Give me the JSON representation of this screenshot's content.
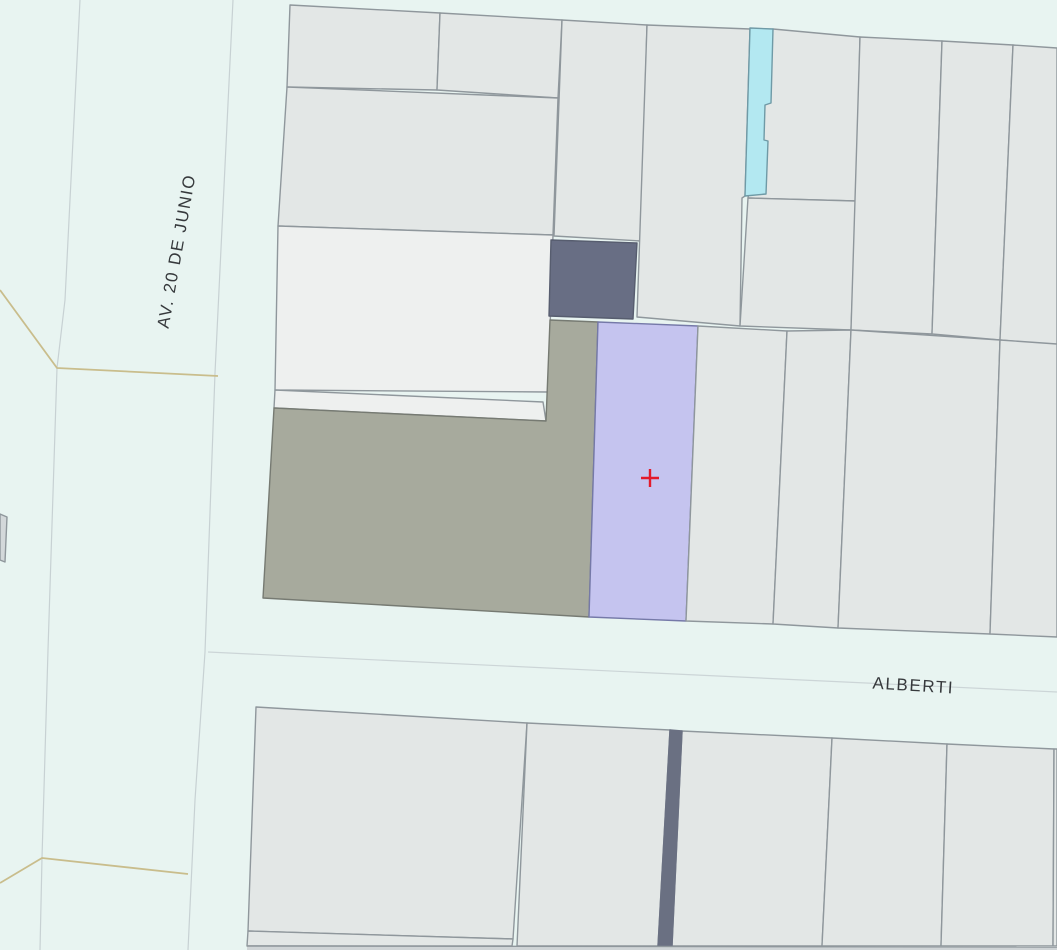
{
  "map": {
    "kind": "cadastral-parcel-map",
    "street_labels": [
      {
        "id": "av-20-de-junio",
        "text": "AV. 20 DE JUNIO",
        "orientation": "vertical"
      },
      {
        "id": "alberti",
        "text": "ALBERTI",
        "orientation": "horizontal"
      }
    ],
    "selected_parcel": {
      "marker_icon": "red-cross",
      "fill": "#c5c4ef",
      "border": "#7579a8"
    },
    "colors": {
      "street": "#e8f4f1",
      "parcel": "#e3e7e6",
      "parcel_light": "#eef0ef",
      "parcel_border": "#8f979c",
      "building_dark": "#686e84",
      "building_dark_border": "#575d6f",
      "strip_dark": "#6a7082",
      "greenspace": "#a7aa9d",
      "greenspace_border": "#767a72",
      "water": "#b3e8f1",
      "water_border": "#6f9aa6",
      "section_line": "#c9bd8c",
      "street_edge": "#c7d1d3",
      "centerline": "#ccd5d7",
      "label": "#36393c",
      "marker": "#e31a2b",
      "canvas_edge": "#cfd4d6",
      "sliver": "#d3d8da"
    }
  }
}
